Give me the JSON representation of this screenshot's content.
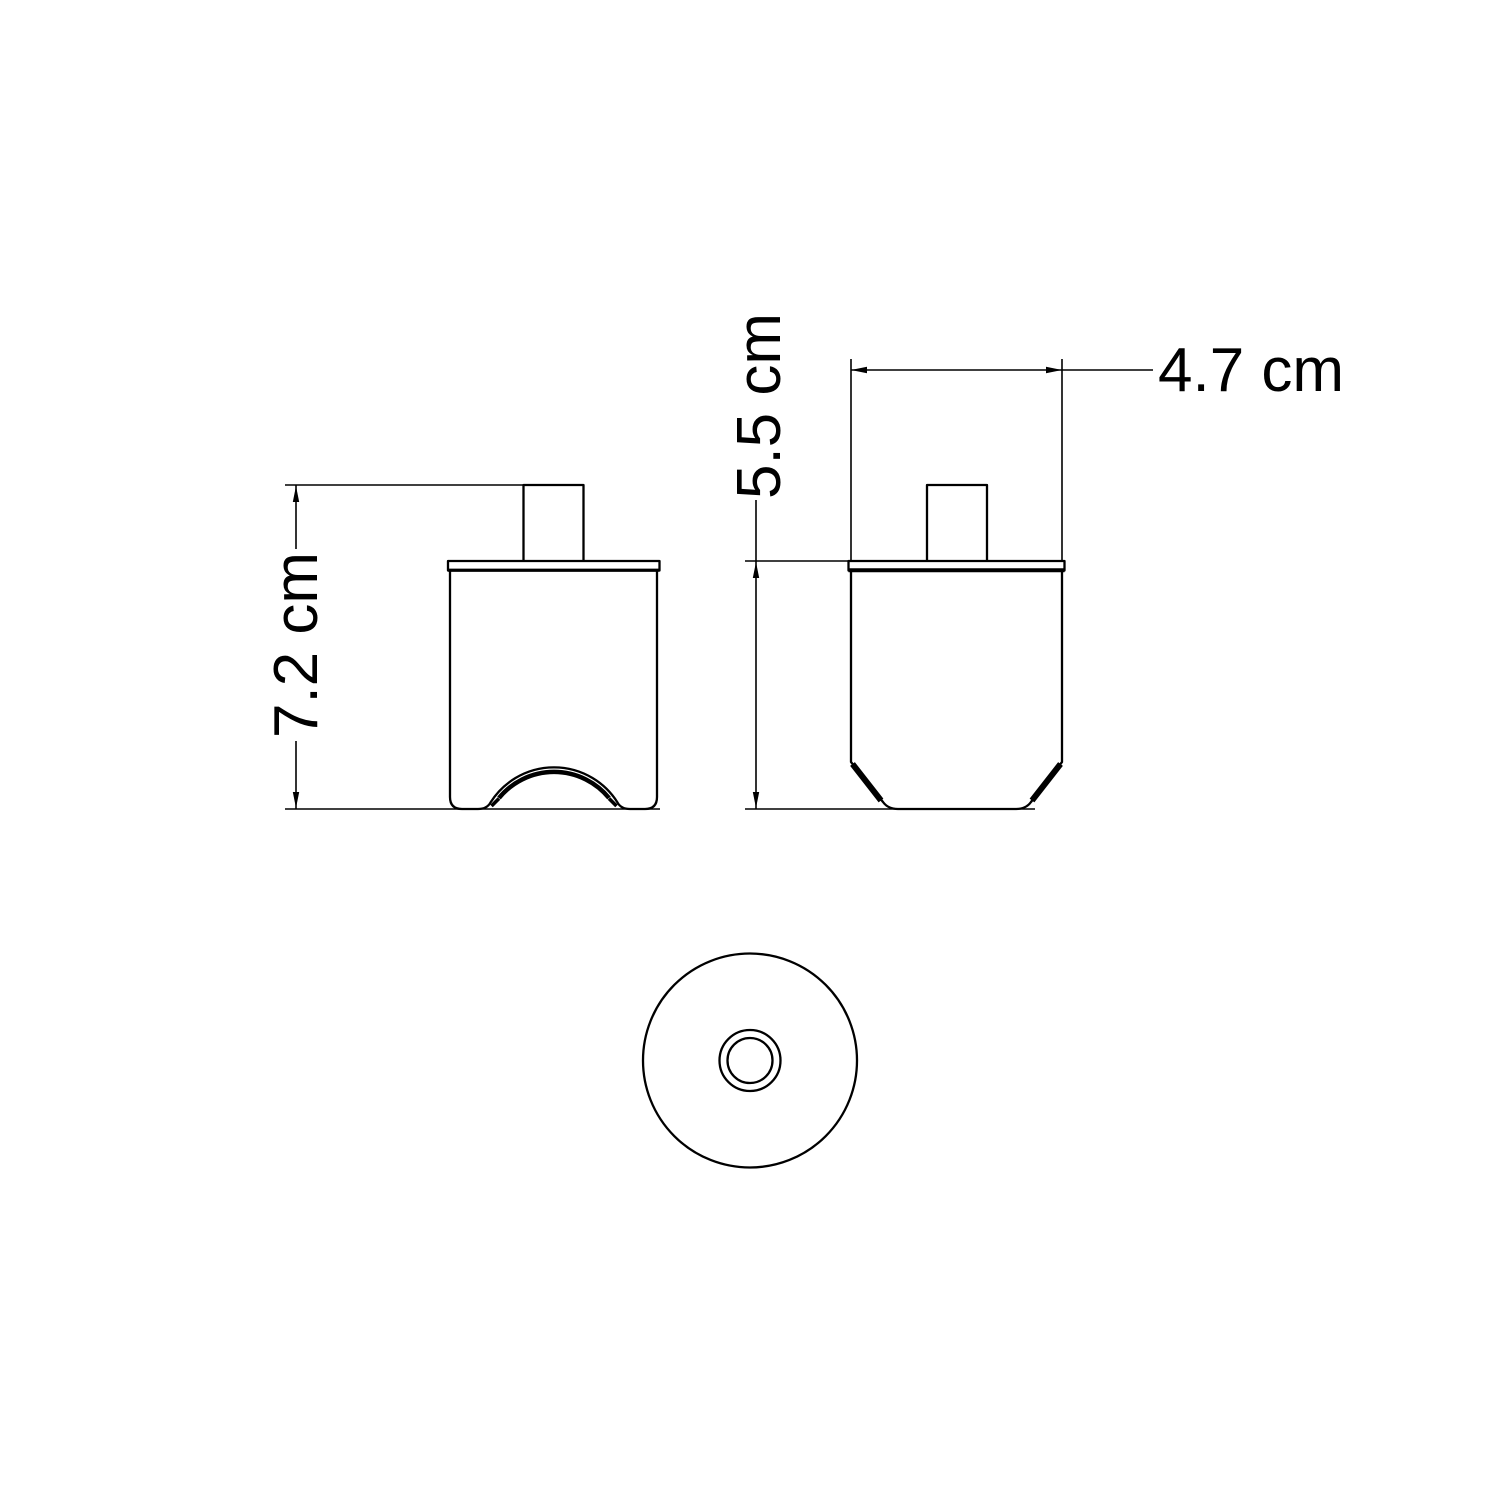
{
  "drawing": {
    "dimension_labels": {
      "front_height": "7.2 cm",
      "side_height": "5.5 cm",
      "side_width": "4.7 cm"
    },
    "colors": {
      "line": "#000000",
      "background": "#ffffff"
    }
  }
}
